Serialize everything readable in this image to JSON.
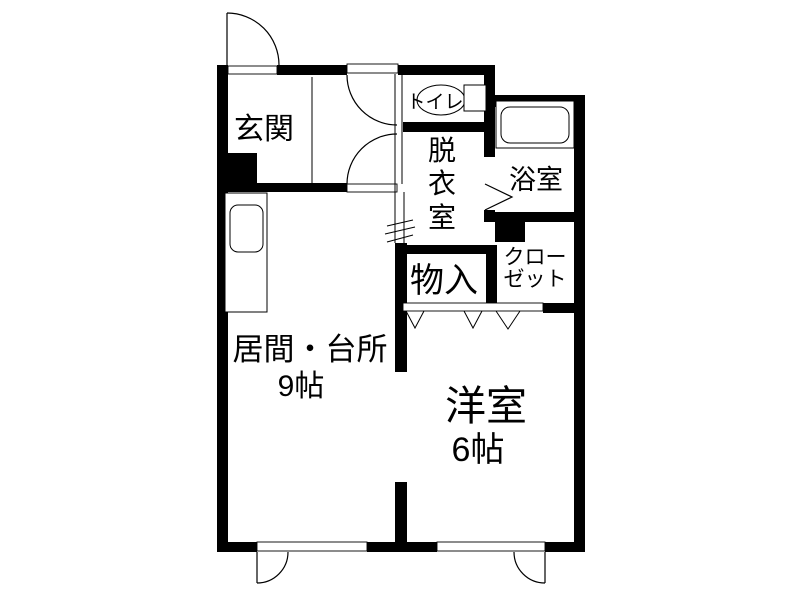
{
  "title": "apartment-floor-plan",
  "colors": {
    "wall": "#000000",
    "floor": "#ffffff",
    "text": "#000000"
  },
  "rooms": {
    "genkan": {
      "label": "玄関"
    },
    "toilet": {
      "label": "トイレ"
    },
    "dressing": {
      "label": "脱衣室",
      "chars": [
        "脱",
        "衣",
        "室"
      ]
    },
    "bath": {
      "label": "浴室"
    },
    "storage": {
      "label": "物入"
    },
    "closet": {
      "label": "クローゼット",
      "line1": "クロー",
      "line2": "ゼット"
    },
    "living": {
      "label": "居間・台所",
      "size": "9帖"
    },
    "western": {
      "label": "洋室",
      "size": "6帖"
    }
  }
}
